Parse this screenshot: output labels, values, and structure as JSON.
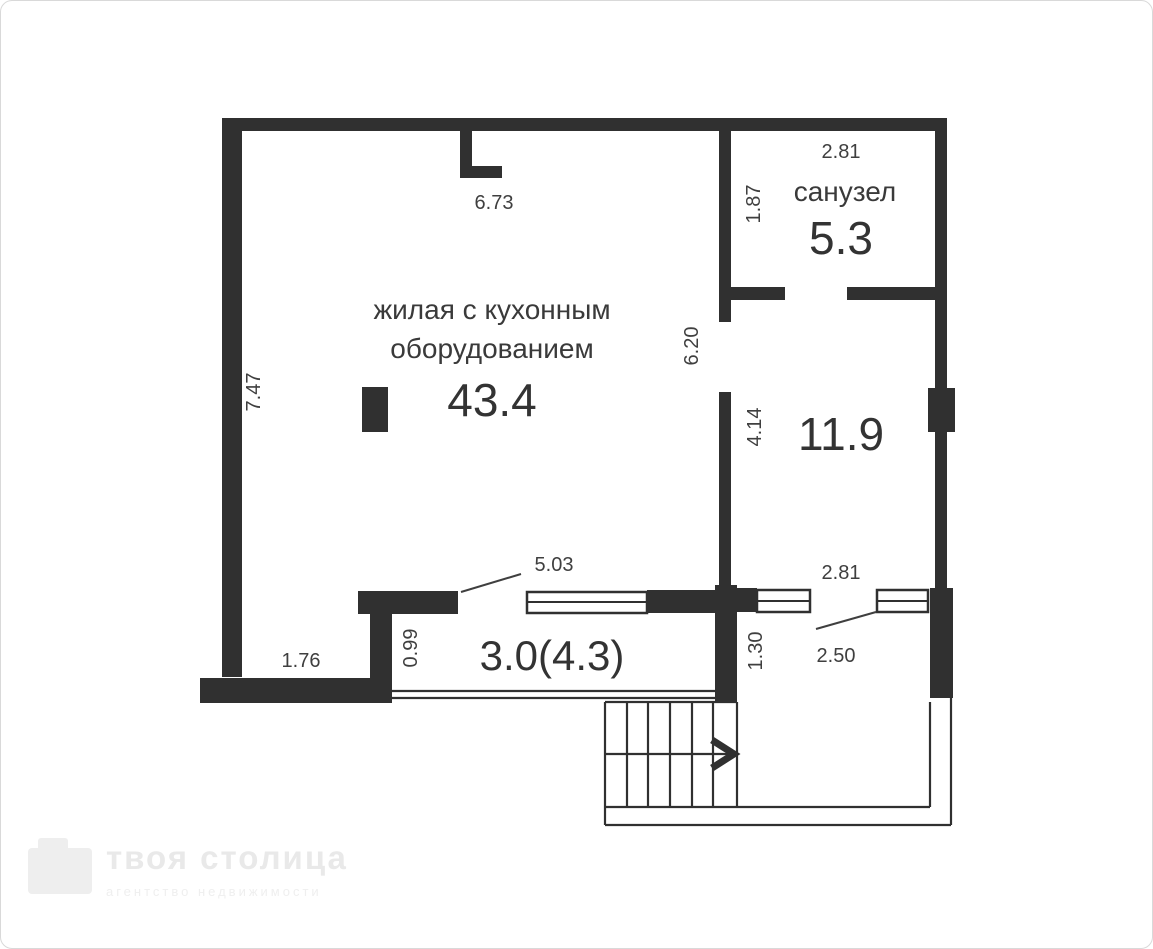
{
  "canvas": {
    "wall_color": "#303030",
    "line_color": "#303030",
    "text_color": "#3f3f3f",
    "background": "#ffffff",
    "frame_border": "#d9d9d9"
  },
  "rooms": {
    "living": {
      "name_line1": "жилая с кухонным",
      "name_line2": "оборудованием",
      "area": "43.4"
    },
    "bathroom": {
      "name": "санузел",
      "area": "5.3"
    },
    "room_right": {
      "area": "11.9"
    },
    "balcony": {
      "area": "3.0(4.3)"
    }
  },
  "dimensions": {
    "top_width": "6.73",
    "bathroom_width": "2.81",
    "bathroom_depth": "1.87",
    "living_height": "7.47",
    "divider_upper": "6.20",
    "divider_lower": "4.14",
    "balcony_opening": "5.03",
    "lower_width": "2.81",
    "balcony_depth": "0.99",
    "balcony_left": "1.76",
    "lower_passage": "1.30",
    "lower_opening": "2.50"
  },
  "watermark": {
    "title": "твоя столица",
    "subtitle": "агентство недвижимости"
  }
}
